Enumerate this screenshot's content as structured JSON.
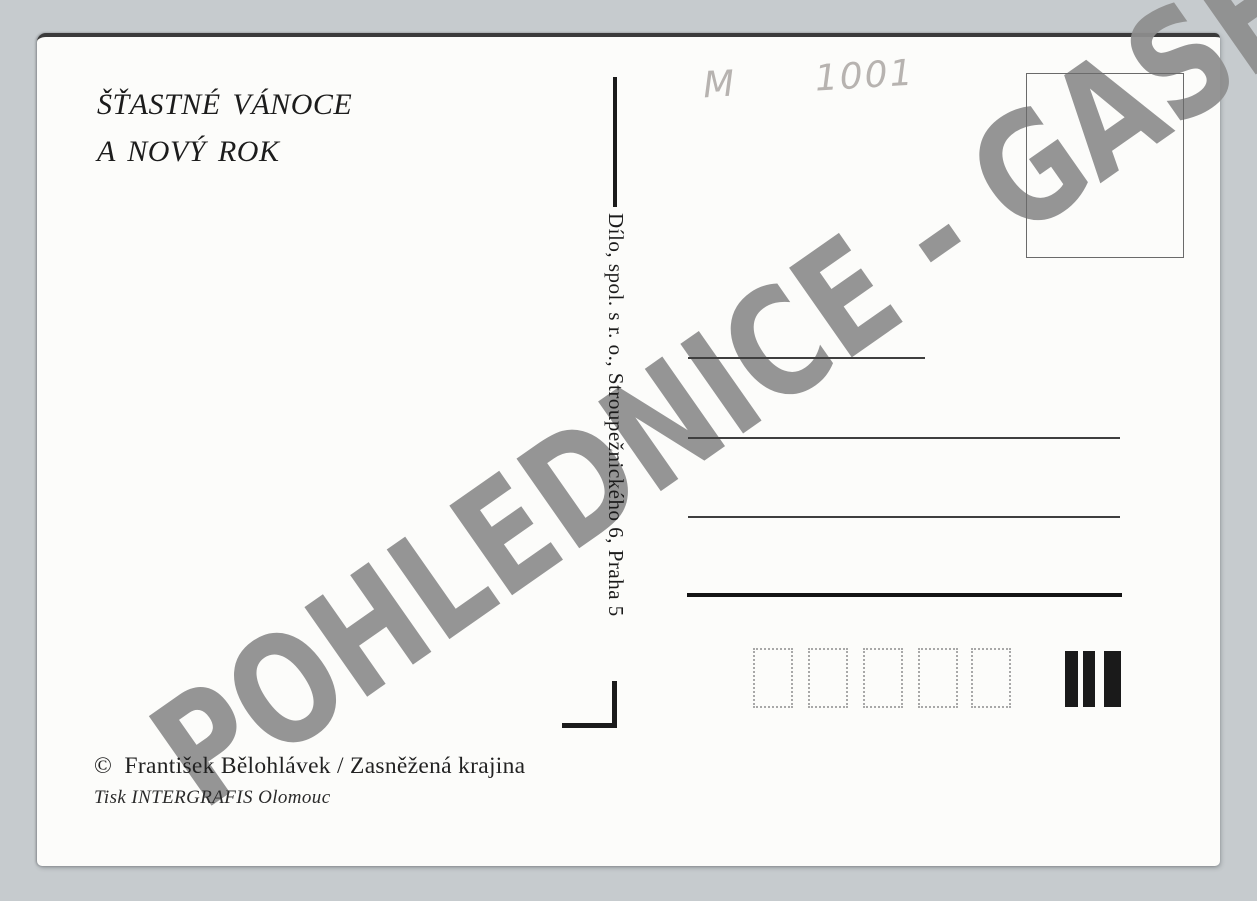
{
  "postcard": {
    "greeting": {
      "line1": "ŠŤASTNÉ VÁNOCE",
      "line2": "A NOVÝ ROK"
    },
    "handwritten_note": "M  1001",
    "publisher_line": "Dílo, spol. s r. o., Stroupežnického 6, Praha 5",
    "credits": {
      "artist": "©  František Bělohlávek / Zasněžená krajina",
      "printer": "Tisk INTERGRAFIS Olomouc"
    },
    "watermark": {
      "text": "POHLEDNICE - GASH",
      "color": "#8e8e8e"
    },
    "address_line_count": 4,
    "postal_code_box_count": 5,
    "sorting_bar_count": 3,
    "colors": {
      "scan_background": "#c6cbce",
      "card_background": "#fcfcfa",
      "ink": "#1b1b1b",
      "pencil": "#b7b3b0"
    }
  }
}
